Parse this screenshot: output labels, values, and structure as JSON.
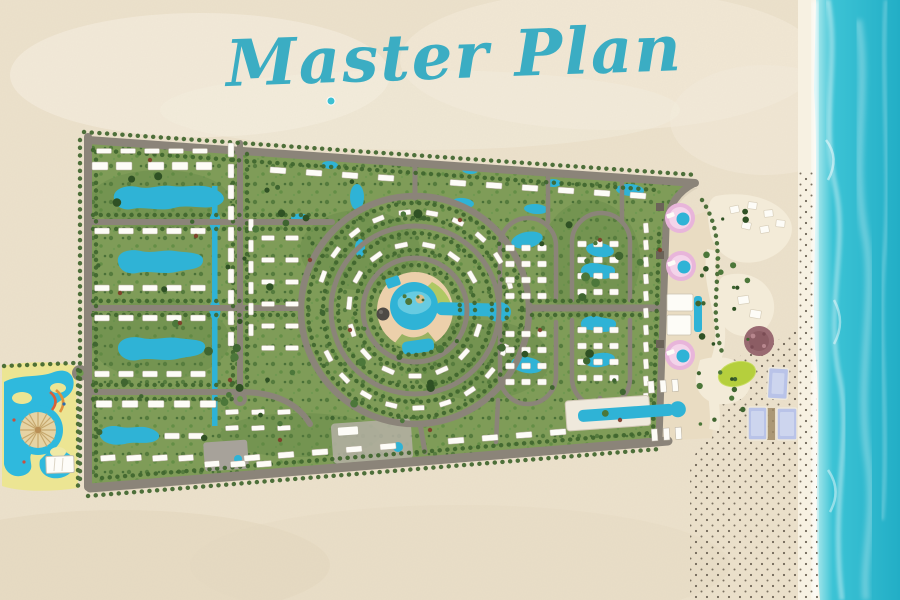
{
  "title": {
    "text": "Master Plan"
  },
  "colors": {
    "sand": "#ece1cb",
    "ocean_near": "#b9eef0",
    "ocean": "#3cc3d5",
    "ocean_deep": "#22aec6",
    "title": "#3badc3",
    "road": "#8b8479",
    "vegetation": "#7f9c58",
    "building": "#fdfcf7",
    "pool": "#2fb3d6",
    "deck": "#ecd0ab",
    "pink": "#e8b5da",
    "lime": "#b5cf3d",
    "cream": "#e9dcc2",
    "beach_path": "#f3ebd8",
    "cabana": "#b9c3e8",
    "umbrella": "#6f6557",
    "park_water": "#2fb9dd",
    "park_sand": "#ece593"
  }
}
